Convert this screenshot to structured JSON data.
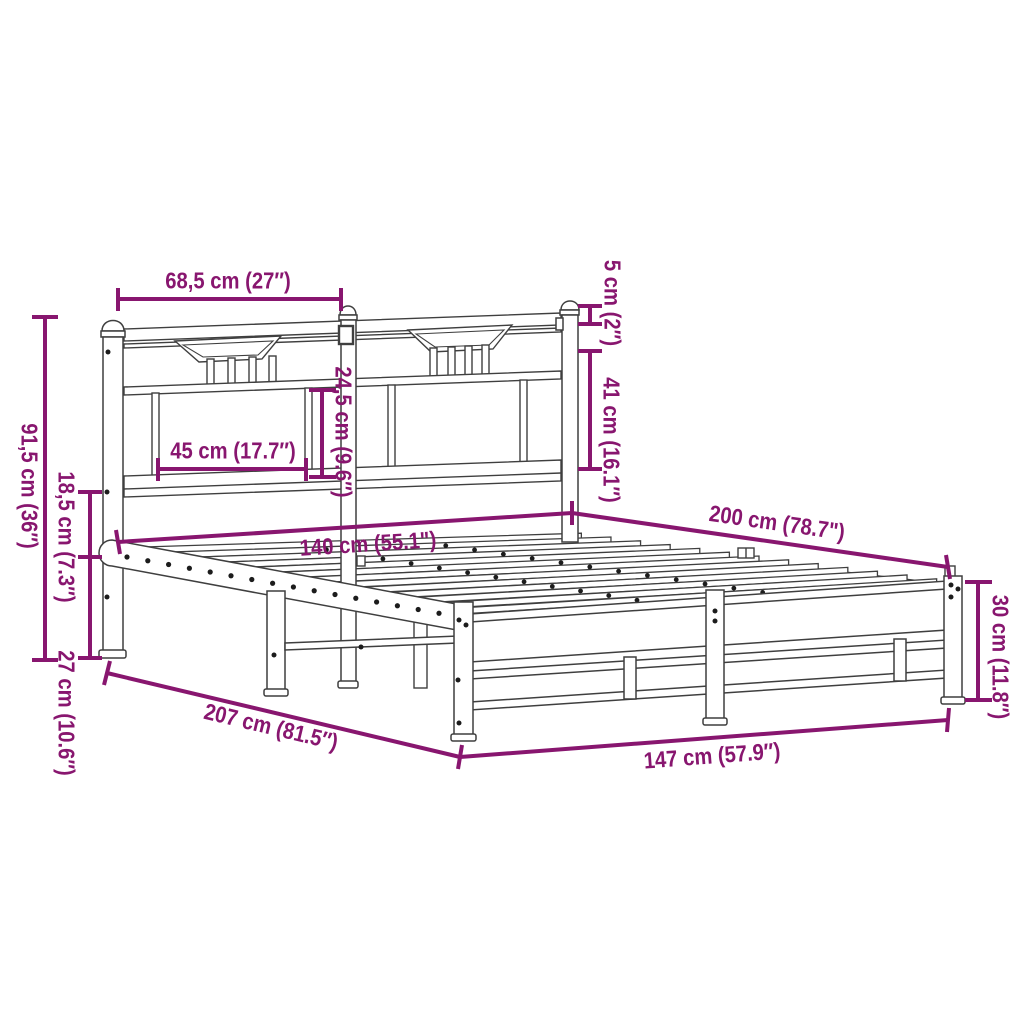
{
  "colors": {
    "dimension_annotation": "#88166F",
    "line_art": "#3F3F3F",
    "background": "#FFFFFF"
  },
  "dimensions": {
    "headboard_section_width": {
      "label": "68,5 cm (27″)"
    },
    "post_cap_height": {
      "label": "5 cm (2″)"
    },
    "headboard_panel_height": {
      "label": "41 cm (16.1″)"
    },
    "headboard_total_height": {
      "label": "91,5 cm (36″)"
    },
    "underbed_clearance": {
      "label": "18,5 cm (7.3″)"
    },
    "side_rail_height": {
      "label": "27 cm (10.6″)"
    },
    "headboard_opening_width": {
      "label": "45 cm (17.7″)"
    },
    "headboard_inner_height": {
      "label": "24,5 cm (9.6″)"
    },
    "bed_width": {
      "label": "140 cm (55.1\")"
    },
    "bed_length": {
      "label": "200 cm (78.7\")"
    },
    "footboard_height": {
      "label": "30 cm (11.8″)"
    },
    "total_length": {
      "label": "207 cm (81.5″)"
    },
    "total_width": {
      "label": "147 cm (57.9″)"
    }
  }
}
